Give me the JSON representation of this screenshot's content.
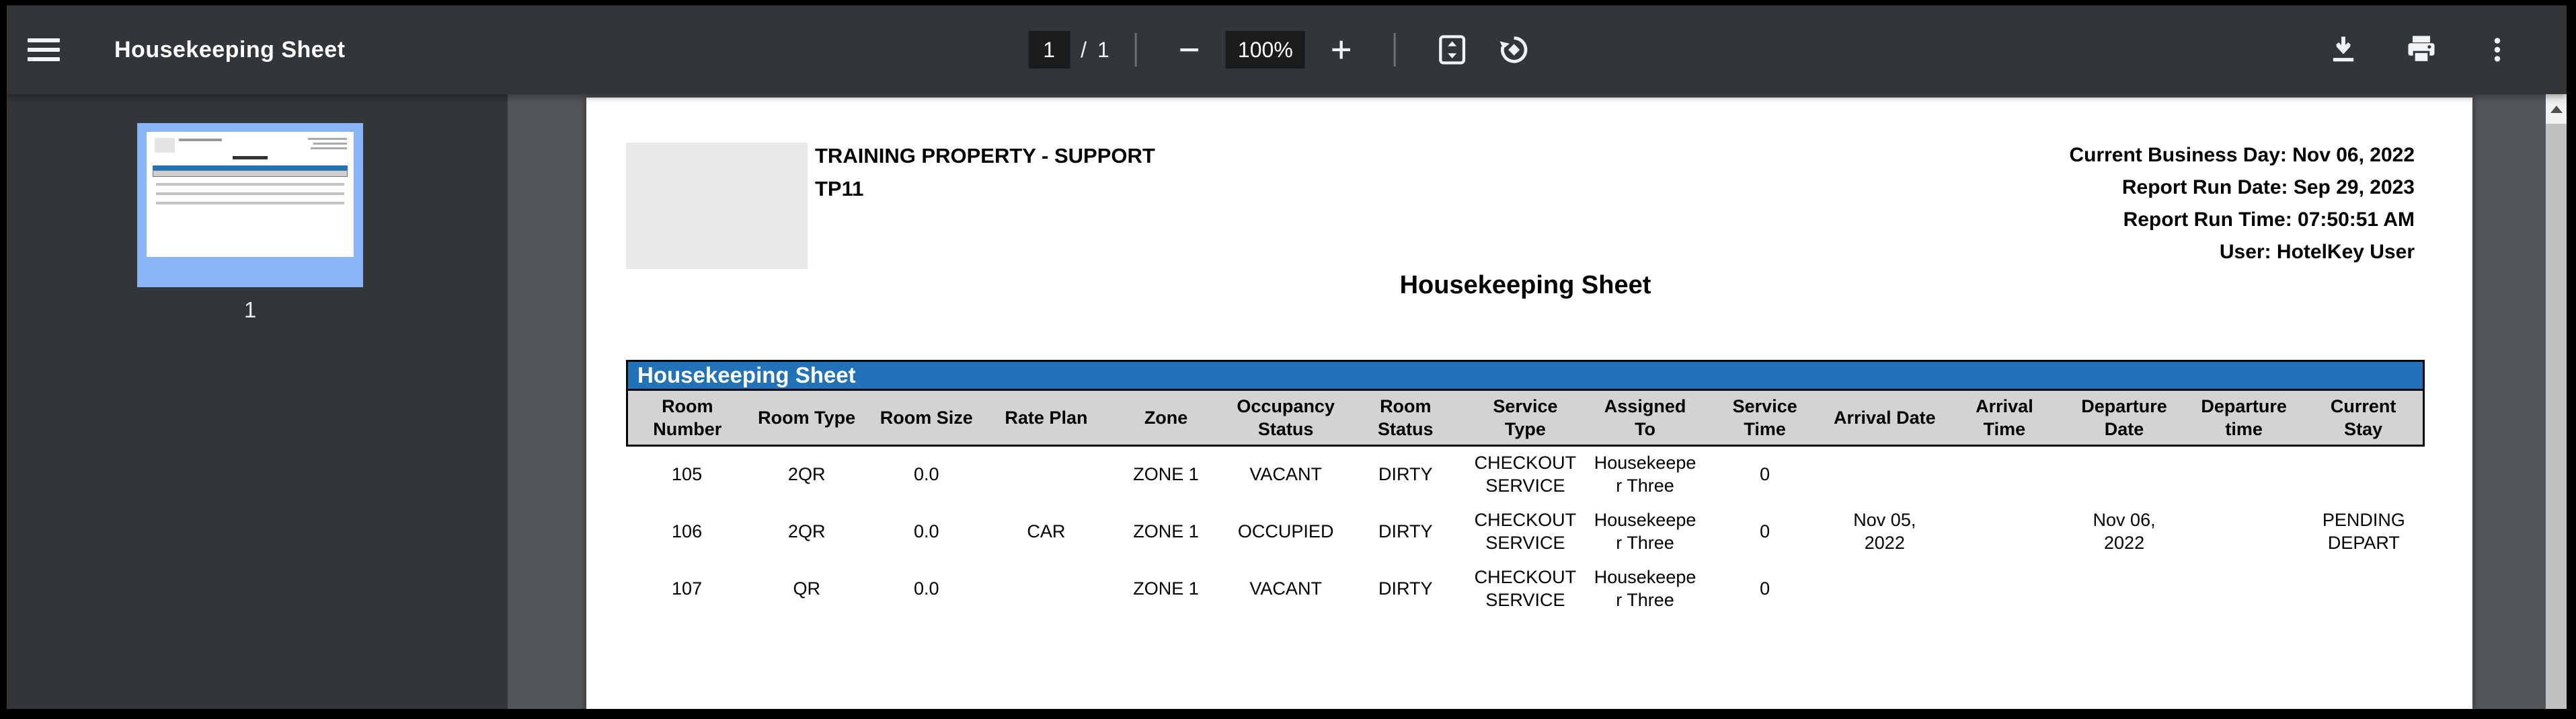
{
  "toolbar": {
    "title": "Housekeeping Sheet",
    "page_current": "1",
    "page_separator": "/",
    "page_total": "1",
    "zoom_level": "100%",
    "icons": [
      "menu-icon",
      "zoom-out-icon",
      "zoom-in-icon",
      "fit-to-page-icon",
      "rotate-counterclockwise-icon",
      "download-icon",
      "print-icon",
      "more-options-icon"
    ]
  },
  "sidebar": {
    "thumbnail_page_number": "1"
  },
  "document": {
    "property_name": "TRAINING PROPERTY - SUPPORT",
    "property_code": "TP11",
    "meta_lines": [
      "Current Business Day: Nov 06, 2022",
      "Report Run Date: Sep 29, 2023",
      "Report Run Time: 07:50:51 AM",
      "User: HotelKey User"
    ],
    "title": "Housekeeping Sheet",
    "table": {
      "title": "Housekeeping Sheet",
      "columns": [
        {
          "id": "room_number",
          "label": "Room\nNumber"
        },
        {
          "id": "room_type",
          "label": "Room Type"
        },
        {
          "id": "room_size",
          "label": "Room Size"
        },
        {
          "id": "rate_plan",
          "label": "Rate Plan"
        },
        {
          "id": "zone",
          "label": "Zone"
        },
        {
          "id": "occupancy_status",
          "label": "Occupancy\nStatus"
        },
        {
          "id": "room_status",
          "label": "Room\nStatus"
        },
        {
          "id": "service_type",
          "label": "Service\nType"
        },
        {
          "id": "assigned_to",
          "label": "Assigned\nTo"
        },
        {
          "id": "service_time",
          "label": "Service\nTime"
        },
        {
          "id": "arrival_date",
          "label": "Arrival Date"
        },
        {
          "id": "arrival_time",
          "label": "Arrival\nTime"
        },
        {
          "id": "departure_date",
          "label": "Departure\nDate"
        },
        {
          "id": "departure_time",
          "label": "Departure\ntime"
        },
        {
          "id": "current_stay",
          "label": "Current\nStay"
        }
      ],
      "rows": [
        [
          "105",
          "2QR",
          "0.0",
          "",
          "ZONE 1",
          "VACANT",
          "DIRTY",
          "CHECKOUT\nSERVICE",
          "Housekeeper Three",
          "0",
          "",
          "",
          "",
          "",
          ""
        ],
        [
          "106",
          "2QR",
          "0.0",
          "CAR",
          "ZONE 1",
          "OCCUPIED",
          "DIRTY",
          "CHECKOUT\nSERVICE",
          "Housekeeper Three",
          "0",
          "Nov 05,\n2022",
          "",
          "Nov 06,\n2022",
          "",
          "PENDING\nDEPART"
        ],
        [
          "107",
          "QR",
          "0.0",
          "",
          "ZONE 1",
          "VACANT",
          "DIRTY",
          "CHECKOUT\nSERVICE",
          "Housekeeper Three",
          "0",
          "",
          "",
          "",
          "",
          ""
        ]
      ]
    }
  },
  "colors": {
    "accent_blue": "#2272b9",
    "table_header_gray": "#d3d3d3",
    "thumbnail_selected_blue": "#8ab4f8",
    "toolbar_background": "#323639",
    "viewer_background": "#525659"
  }
}
